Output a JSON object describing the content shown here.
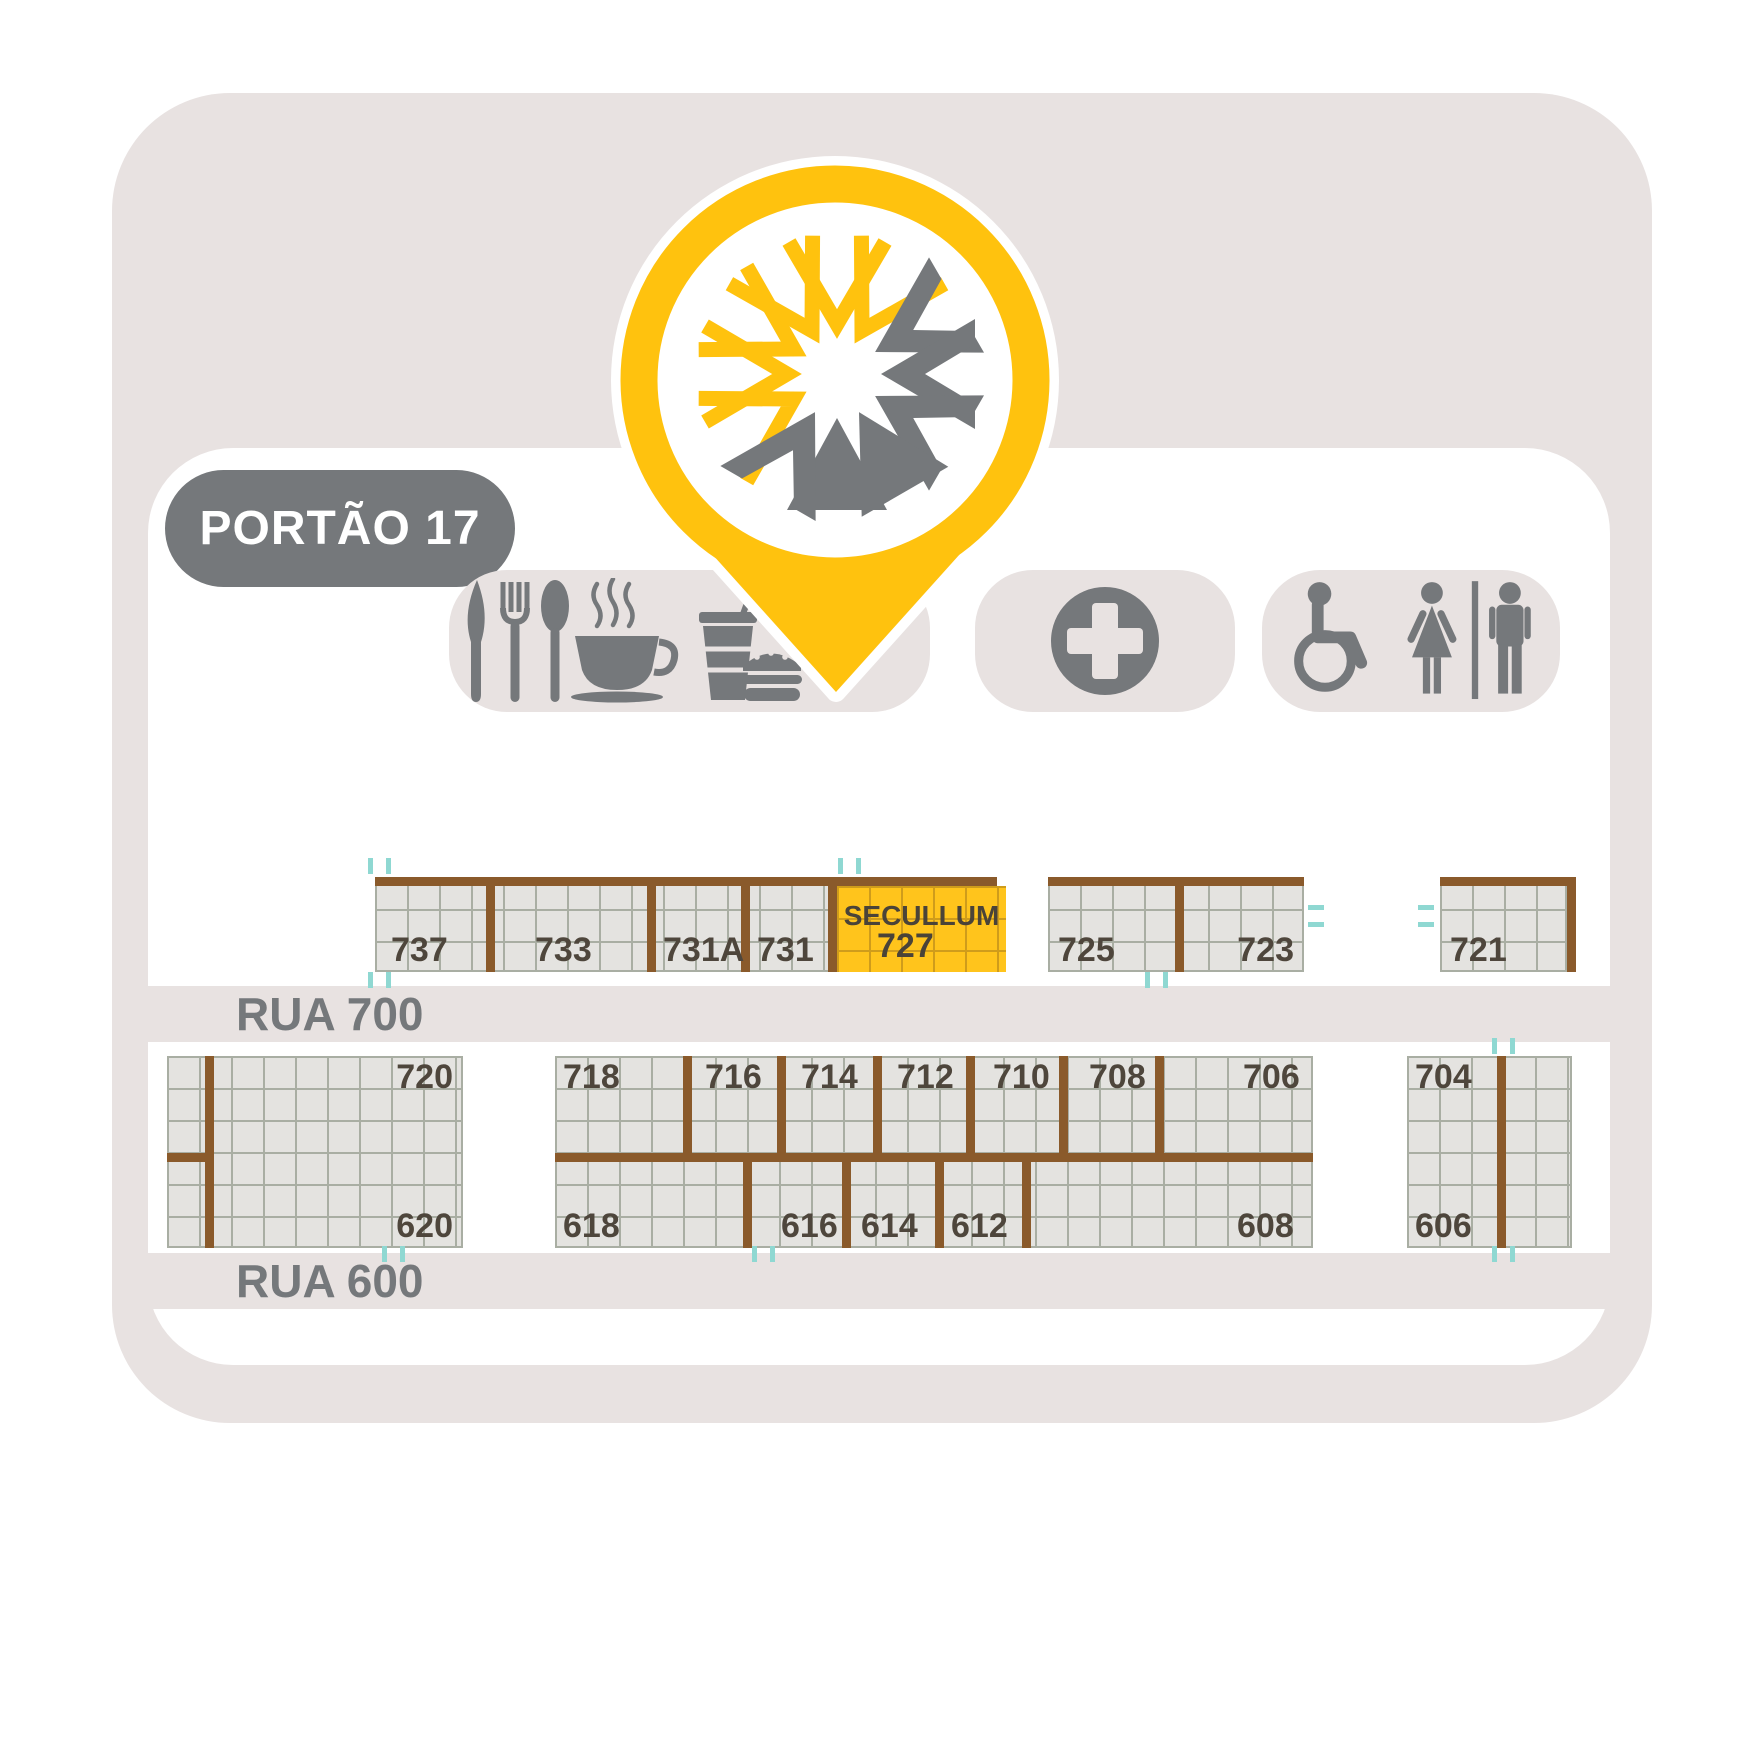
{
  "gate": {
    "label": "PORTÃO 17"
  },
  "streets": {
    "north": "RUA 700",
    "south": "RUA 600"
  },
  "highlight": {
    "exhibitor": "SECULLUM",
    "booth": "727"
  },
  "blocks": {
    "a": [
      "737",
      "733",
      "731A",
      "731"
    ],
    "b": [
      "725",
      "723"
    ],
    "c": [
      "721"
    ],
    "d": [
      "720",
      "620"
    ],
    "e_top": [
      "718",
      "716",
      "714",
      "712",
      "710",
      "708",
      "706"
    ],
    "e_bottom": [
      "618",
      "616",
      "614",
      "612",
      "608"
    ],
    "f": [
      "704",
      "606"
    ]
  },
  "amenities": {
    "food": [
      "restaurant-icon",
      "coffee-icon",
      "fastfood-icon"
    ],
    "medical": [
      "first-aid-icon"
    ],
    "restroom": [
      "wheelchair-icon",
      "women-restroom-icon",
      "men-restroom-icon"
    ]
  },
  "colors": {
    "accent_yellow": "#FFC20E",
    "icon_gray": "#75787B",
    "panel_pink": "#E8E2E1",
    "booth_brown": "#8A5A2B",
    "booth_fill": "#E4E3E0",
    "highlight_yellow": "#FFC41C",
    "number_text": "#4E463C",
    "registration_mark_teal": "#8FD8D2"
  }
}
